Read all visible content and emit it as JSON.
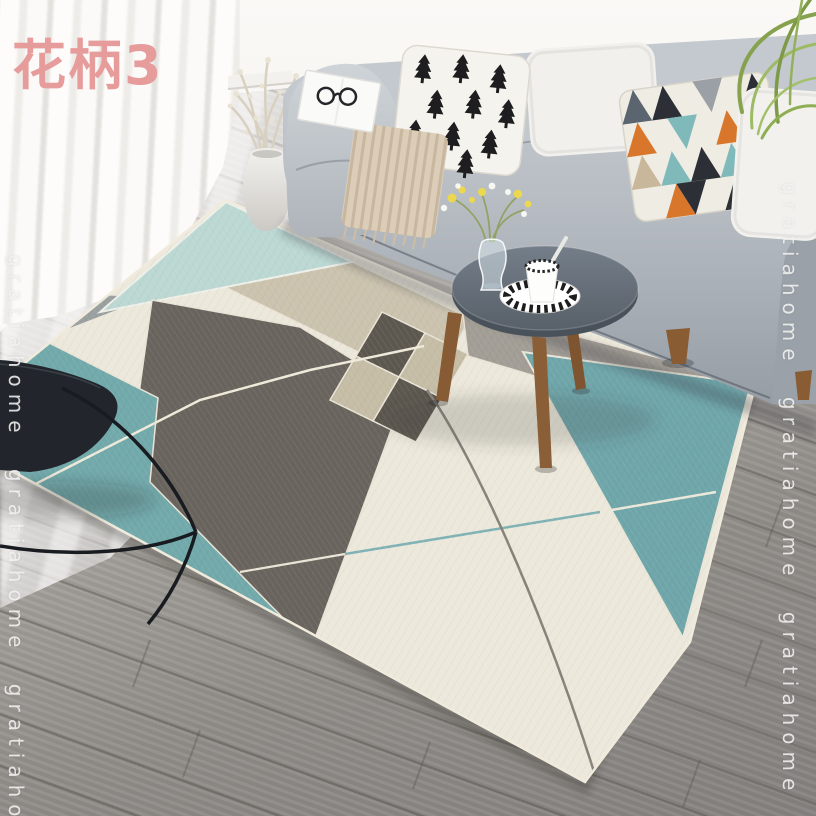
{
  "variant_label": {
    "text": "花柄3"
  },
  "watermark": {
    "word": "gratiahome",
    "left_column": "gratiahome gratiahome gratiahome",
    "right_column": "gratiahome gratiahome gratiahome"
  },
  "colors": {
    "label_pink": "#e79c9c",
    "watermark_text": "#f3f3f1",
    "rug_cream": "#ece8db",
    "rug_mint": "#bcd8d3",
    "rug_teal_right": "#6fa6aa",
    "rug_teal_left": "#72a9ab",
    "rug_dark_gray": "#6a645e",
    "rug_tan": "#cbc3ae",
    "rug_gray_mid": "#a29d95",
    "rug_left_gray": "#9aa09f",
    "rug_checker_dark": "#5d584f",
    "rug_checker_tan": "#c6bda6",
    "sofa_gray": "#b5bbc1",
    "floor_wood": "#a19d99",
    "table_top": "#5f6973",
    "wood_leg_brown": "#8a5c33",
    "throw_beige": "#dbcdb8",
    "pillow_orange": "#d8772c",
    "pillow_teal": "#7fb9ba",
    "pillow_black": "#2c2f35",
    "chair_black": "#22262c",
    "plant_green": "#8fae54"
  }
}
